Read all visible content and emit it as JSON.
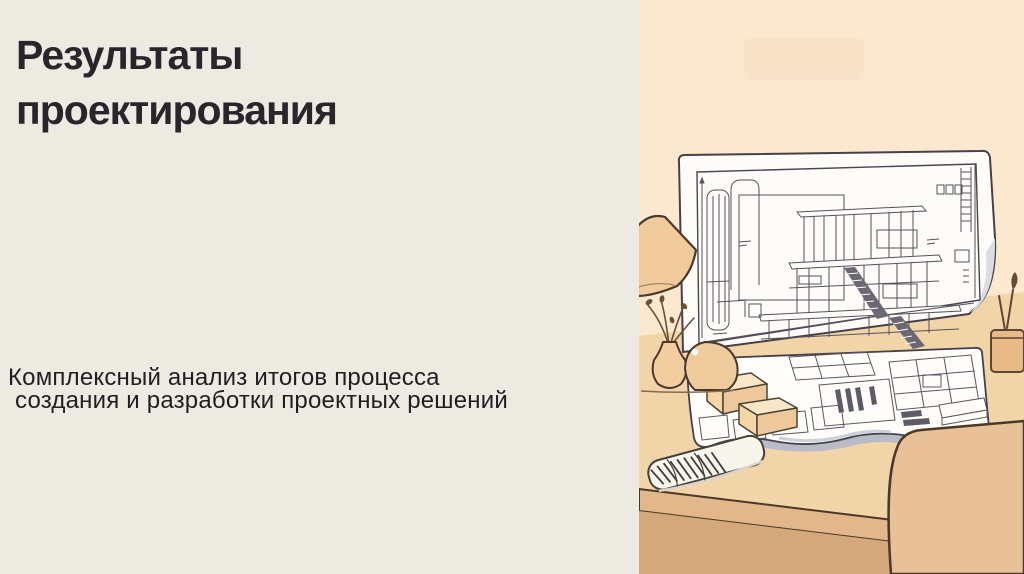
{
  "slide": {
    "title": {
      "line1": "Результаты",
      "line2": "проектирования"
    },
    "subtitle": {
      "line1": "Комплексный анализ итогов процесса",
      "line2": "создания и разработки проектных решений"
    },
    "illustration": {
      "alt": "Архитектурные чертежи дома и план на столе с лампой, вазой, блокнотом, креслом и растением"
    },
    "colors": {
      "background_left": "#edeae1",
      "background_right": "#fbe8ce",
      "title_text": "#28262b",
      "body_text": "#1f1e23",
      "desk_surface": "#f1d2a6",
      "desk_front": "#d3a87b",
      "outline": "#4b382a",
      "paper": "#fdfcf9",
      "drawing_line": "#56525c",
      "shadow_gray": "#b9bbc6"
    }
  }
}
